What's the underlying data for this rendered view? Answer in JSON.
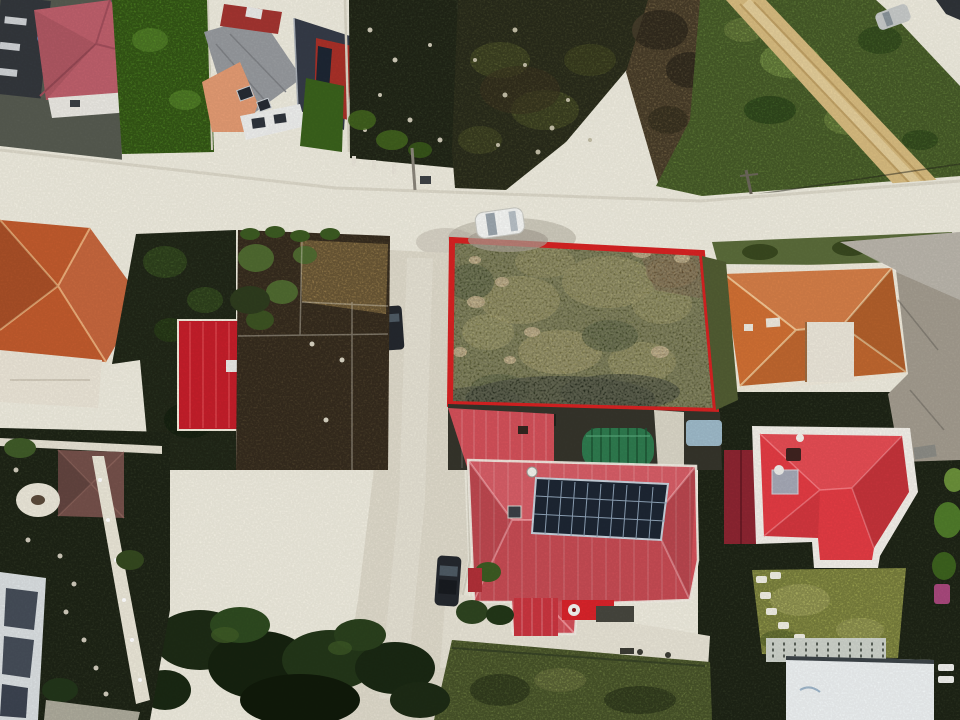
{
  "image": {
    "kind": "aerial drone photograph",
    "description": "Top-down drone view of a suburban neighborhood. A vacant overgrown parcel at top-center is outlined with a thick red boundary. It is bordered by a light dirt road above and left, an orange hip-roof house to the right, and a large pink-red roofed house with a rooftop solar array below. Surrounding lots hold red, crimson, terracotta and maroon roofs, dark gardens, a scrub field, a diagonal dirt track through grass, parked cars and tree canopy.",
    "width": 960,
    "height": 720
  },
  "plot": {
    "label": "highlighted vacant land parcel",
    "points": "452,240 702,253 716,411 450,404",
    "border_color": "#d62222",
    "border_width": 6,
    "fill_color": "#65683a"
  },
  "colors": {
    "road": "#edeadd",
    "road_vertical": "#ded9ca",
    "field": "#3c3f27",
    "yard_dark": "#2f3622",
    "scrub": "#6e5e40",
    "scrub_grass": "#66763c",
    "grass": "#5d7836",
    "dirt_path": "#d6ba7e",
    "lawn": "#4a7b20",
    "lawn_yellow": "#9aa14e",
    "garden": "#2b3320",
    "soil": "#93794a",
    "soil_dark": "#4a3d2a",
    "concrete": "#a29b8e",
    "terracotta": "#c05a2d",
    "rose": "#bd5f6b",
    "shingle": "#96999d",
    "navy": "#353b47",
    "salmon": "#e29a72",
    "crimson": "#c41e2a",
    "gray_blue": "#8595a5",
    "orange": "#cf6f33",
    "pink_red": "#d25059",
    "bright_red": "#e23b43",
    "maroon": "#8c2531",
    "shed_brown": "#74504a",
    "dark_building": "#33373c",
    "building_white": "#ecf0f1",
    "solar": "#1d2633",
    "greenhouse": "#2e7a4e",
    "car_dark": "#24282e",
    "car_white": "#f4f5f3",
    "car_silver": "#c6c9c8",
    "vehicle_blue": "#9db9c8",
    "flag_red": "#d8232a",
    "magenta": "#a8487c"
  },
  "landmarks": [
    {
      "name": "highlighted-plot",
      "description": "overgrown parcel outlined in red, top center"
    },
    {
      "name": "white-car",
      "description": "white car parked on the road above the plot"
    },
    {
      "name": "solar-house",
      "description": "pink-red roofed house with rooftop solar array below the plot"
    },
    {
      "name": "greenhouse-tunnel",
      "description": "green arched tunnel beside the solar house"
    },
    {
      "name": "orange-roof-house",
      "description": "orange hip-roof house right of the plot"
    },
    {
      "name": "red-roof-house",
      "description": "bright red hip-roof house at bottom right"
    },
    {
      "name": "terracotta-house",
      "description": "terracotta hip-roof house at mid left"
    },
    {
      "name": "crimson-roof-house",
      "description": "crimson metal-roof house at center left"
    },
    {
      "name": "dirt-track",
      "description": "diagonal dirt track through grass, top right"
    },
    {
      "name": "road-junction",
      "description": "light road junction left of the plot"
    }
  ]
}
